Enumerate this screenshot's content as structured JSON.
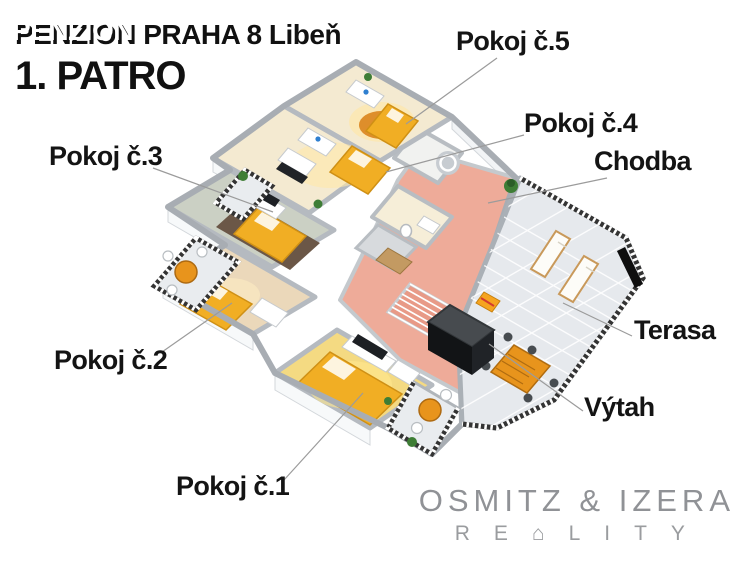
{
  "header": {
    "title_line1": "PENZION PRAHA 8 Libeň",
    "title_glitch_overlay": "PENZION",
    "title_line2": "1. PATRO"
  },
  "labels": {
    "pokoj5": "Pokoj č.5",
    "pokoj4": "Pokoj č.4",
    "chodba": "Chodba",
    "pokoj3": "Pokoj č.3",
    "pokoj2": "Pokoj č.2",
    "pokoj1": "Pokoj č.1",
    "terasa": "Terasa",
    "vytah": "Výtah"
  },
  "logo": {
    "line1": "OSMITZ & IZERA",
    "line2": "RE⌂LITY"
  },
  "colors": {
    "label_text": "#141414",
    "corridor_salmon": "#eeab99",
    "room_cream": "#f4ead1",
    "room1_yellow": "#f4da82",
    "room2_tan": "#ebd8ba",
    "room3_sage": "#cbd0c4",
    "bed_orange": "#f1ae24",
    "rug_orange": "#de8e2b",
    "rug_brown": "#6b5747",
    "terrace_tile": "#e6e9ed",
    "wall_gray": "#b2b7bd",
    "elevator_dark": "#121416",
    "plant_green": "#3e7d35",
    "logo_gray": "#8f9194"
  }
}
